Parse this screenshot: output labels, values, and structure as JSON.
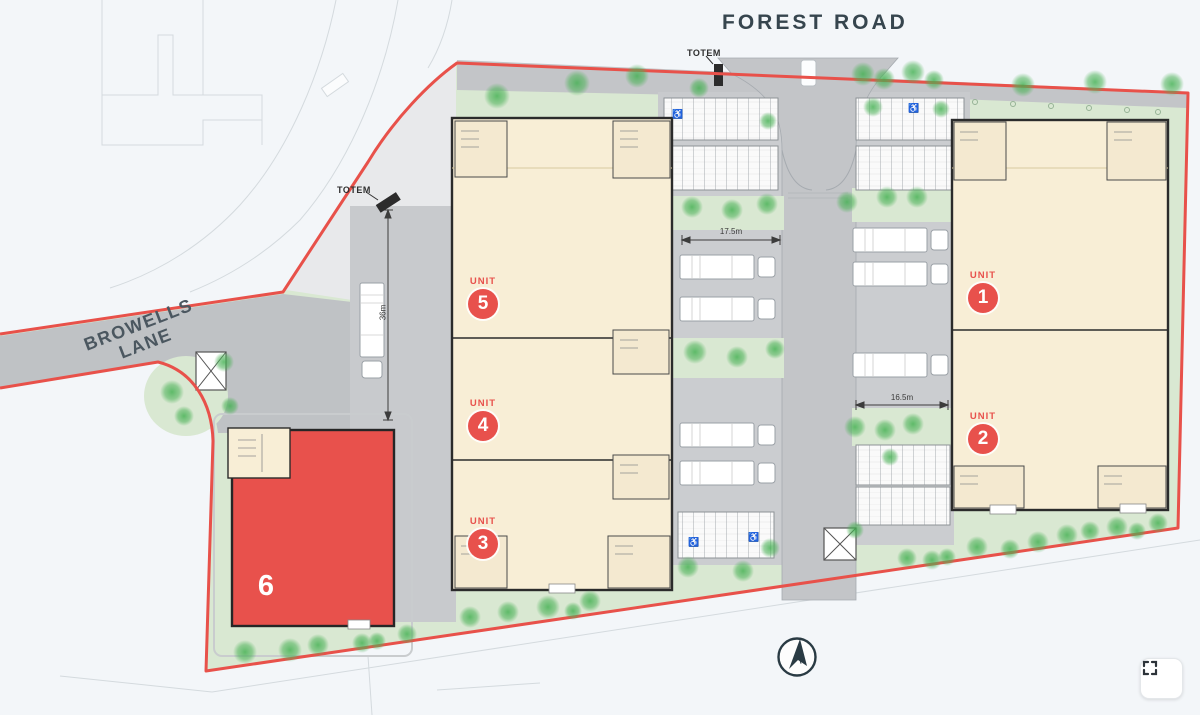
{
  "plan": {
    "forest_road_label": "FOREST ROAD",
    "browells_lane": {
      "line1": "BROWELLS",
      "line2": "LANE"
    },
    "totem_top": "TOTEM",
    "totem_left": "TOTEM",
    "units": {
      "u1": {
        "prefix": "UNIT",
        "number": "1"
      },
      "u2": {
        "prefix": "UNIT",
        "number": "2"
      },
      "u3": {
        "prefix": "UNIT",
        "number": "3"
      },
      "u4": {
        "prefix": "UNIT",
        "number": "4"
      },
      "u5": {
        "prefix": "UNIT",
        "number": "5"
      },
      "u6": {
        "number": "6"
      }
    },
    "dimensions": {
      "left_yard": "17.5m",
      "right_yard": "16.5m",
      "staging_depth": "36m"
    },
    "compass_letter": "N",
    "icons": {
      "accessible": "♿"
    },
    "colors": {
      "boundary_red": "#e8514a",
      "building_cream": "#f8eed6",
      "unit6_red": "#e8514c",
      "landscape_green": "#d9e8d2",
      "road_gray": "#c3c5c8",
      "label_slate": "#36454e"
    }
  }
}
